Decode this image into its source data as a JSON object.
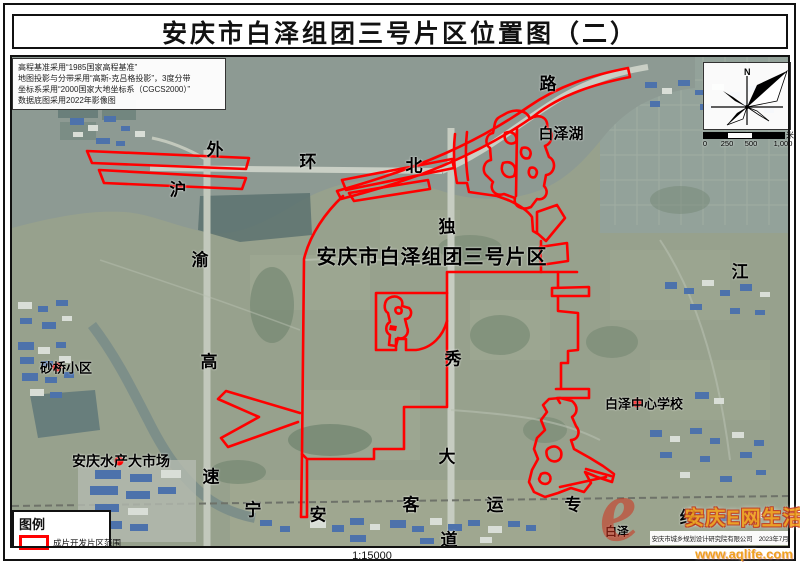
{
  "title": "安庆市白泽组团三号片区位置图（二）",
  "scale_text": "1:15000",
  "notes": [
    "高程基准采用“1985国家高程基准”",
    "地图投影与分带采用“高斯-克吕格投影”，3度分带",
    "坐标系采用“2000国家大地坐标系（CGCS2000）”",
    "数据底图采用2022年影像图"
  ],
  "compass": {
    "north": "N"
  },
  "scalebar": {
    "ticks": [
      "0",
      "250",
      "500",
      "1,000"
    ],
    "unit": "米"
  },
  "legend": {
    "title": "图例",
    "item": "成片开发片区范围",
    "swatch_color": "#ff0000"
  },
  "map": {
    "district_label": {
      "t": "安庆市白泽组团三号片区",
      "x": 432,
      "y": 255,
      "size": 20
    },
    "road_labels": [
      {
        "t": "外",
        "x": 215,
        "y": 148
      },
      {
        "t": "环",
        "x": 308,
        "y": 160
      },
      {
        "t": "北",
        "x": 414,
        "y": 164
      },
      {
        "t": "路",
        "x": 548,
        "y": 82
      },
      {
        "t": "沪",
        "x": 178,
        "y": 188
      },
      {
        "t": "渝",
        "x": 200,
        "y": 258
      },
      {
        "t": "高",
        "x": 209,
        "y": 360
      },
      {
        "t": "速",
        "x": 211,
        "y": 475
      },
      {
        "t": "独",
        "x": 447,
        "y": 225
      },
      {
        "t": "秀",
        "x": 453,
        "y": 357
      },
      {
        "t": "大",
        "x": 447,
        "y": 455
      },
      {
        "t": "道",
        "x": 449,
        "y": 538
      },
      {
        "t": "宁",
        "x": 253,
        "y": 508
      },
      {
        "t": "安",
        "x": 318,
        "y": 513
      },
      {
        "t": "客",
        "x": 411,
        "y": 503
      },
      {
        "t": "运",
        "x": 495,
        "y": 503
      },
      {
        "t": "专",
        "x": 573,
        "y": 503
      },
      {
        "t": "线",
        "x": 688,
        "y": 516
      },
      {
        "t": "江",
        "x": 740,
        "y": 270
      }
    ],
    "place_labels": [
      {
        "t": "白泽湖",
        "x": 561,
        "y": 133,
        "size": 15
      },
      {
        "t": "砂桥小区",
        "x": 66,
        "y": 367,
        "size": 13
      },
      {
        "t": "安庆水产大市场",
        "x": 121,
        "y": 461,
        "size": 14
      },
      {
        "t": "白泽中心学校",
        "x": 644,
        "y": 403,
        "size": 13
      },
      {
        "t": "白泽",
        "x": 617,
        "y": 531,
        "size": 12
      }
    ],
    "poi_dots": [
      {
        "x": 57,
        "y": 367
      },
      {
        "x": 119,
        "y": 461
      },
      {
        "x": 637,
        "y": 403
      }
    ]
  },
  "credit": "安庆市城乡规划设计研究院有限公司　2023年7月",
  "watermark": {
    "logo": "e",
    "brand": "安庆E网生活",
    "url": "www.aqlife.com"
  },
  "colors": {
    "boundary": "#ff0000",
    "dot": "#ff0000"
  }
}
